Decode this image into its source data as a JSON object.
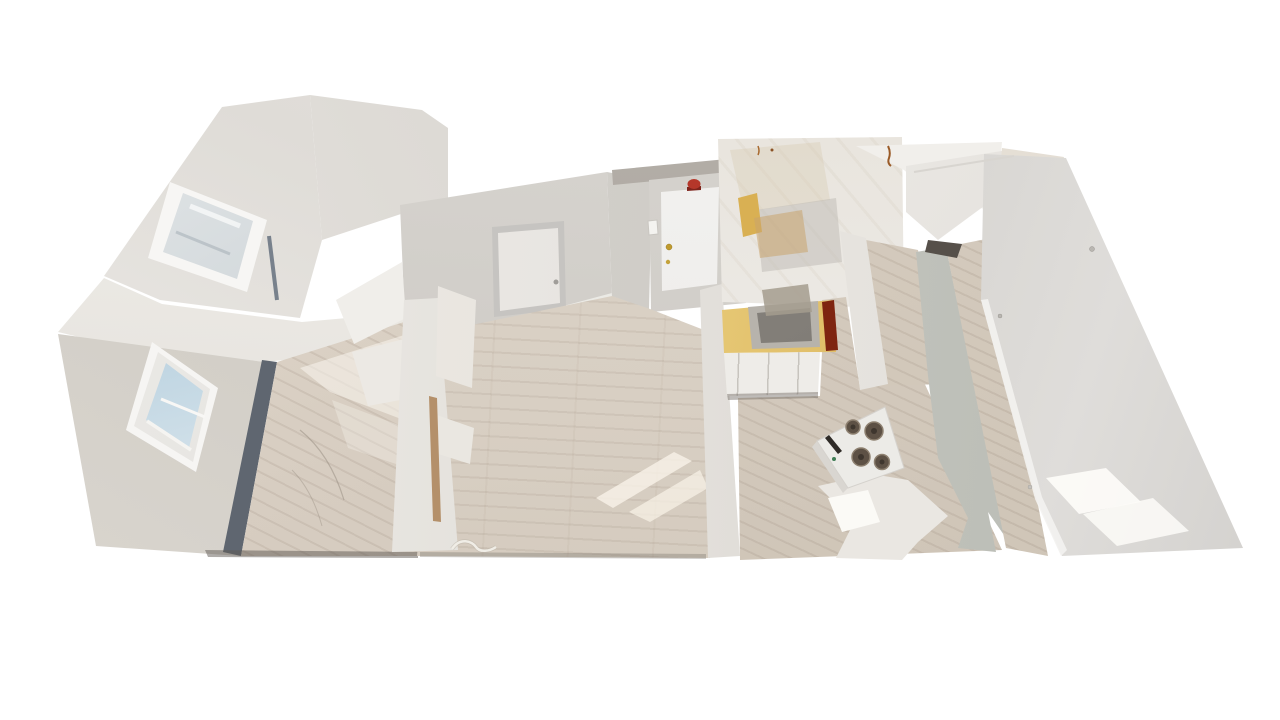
{
  "meta": {
    "view": "3d-dollhouse-scan",
    "description": "Overhead dollhouse view of an empty apartment 3D scan floating on a white background",
    "background_color": "#ffffff"
  },
  "palette": {
    "wall_light": "#f2f0ed",
    "wall_mid": "#d6d3ce",
    "wall_dark": "#bfbcb7",
    "floor_wood": "#d6ccc0",
    "floor_sunlit": "#f9f3e8",
    "baseboard_channel": "#5f6670",
    "window_sky_blue": "#a5c0d2",
    "cabinet_yellow": "#d9b053",
    "counter_gold": "#d3a64a",
    "counter_burn_streak": "#7e2410",
    "sink_steel": "#8d8983",
    "stove_white": "#ecebe7",
    "burner_dark": "#5d5145",
    "front_door_white": "#f4f3f0",
    "fire_alarm_red": "#b5372a",
    "deadbolt_brass": "#bf9a2e",
    "doorway_shadow": "#56504a",
    "torn_mesh_white": "#eae7e2"
  },
  "labels": {
    "scene": "Apartment dollhouse 3D view",
    "bedroom_upper": "Upper-left bedroom with window",
    "bedroom_lower": "Lower-left bedroom with sky-view window",
    "living_room": "Living room with closet and entry door",
    "front_door": "Front entry door with brass deadbolt",
    "fire_alarm": "Red fire alarm above entry door",
    "kitchen": "Kitchen with gold countertop and sink",
    "stove": "White range with four burners",
    "hallway": "Hallway with wood floor",
    "right_room": "Large room with sunlit gray wall"
  },
  "scene": {
    "rooms": [
      {
        "id": "bedroom-upper",
        "features": [
          "window",
          "closet-track-strips",
          "wood-floor-sliver"
        ]
      },
      {
        "id": "bedroom-lower",
        "features": [
          "window-with-blue-sky",
          "sunlit-wood-floor",
          "dark-baseboard-channel"
        ]
      },
      {
        "id": "living-room",
        "features": [
          "closet-door",
          "front-door",
          "fire-alarm",
          "light-switch",
          "sunlight-streaks",
          "floor-cord"
        ]
      },
      {
        "id": "kitchen",
        "features": [
          "upper-cabinets",
          "yellow-scan-streak",
          "sink",
          "gold-countertop",
          "burn-streak",
          "lower-cabinets",
          "stove"
        ]
      },
      {
        "id": "hallway",
        "features": [
          "wood-floor",
          "torn-scan-mesh",
          "white-partition"
        ]
      },
      {
        "id": "right-room",
        "features": [
          "large-gray-wall",
          "two-sun-patches",
          "doorway-gap",
          "diagonal-door-panel"
        ]
      }
    ]
  }
}
